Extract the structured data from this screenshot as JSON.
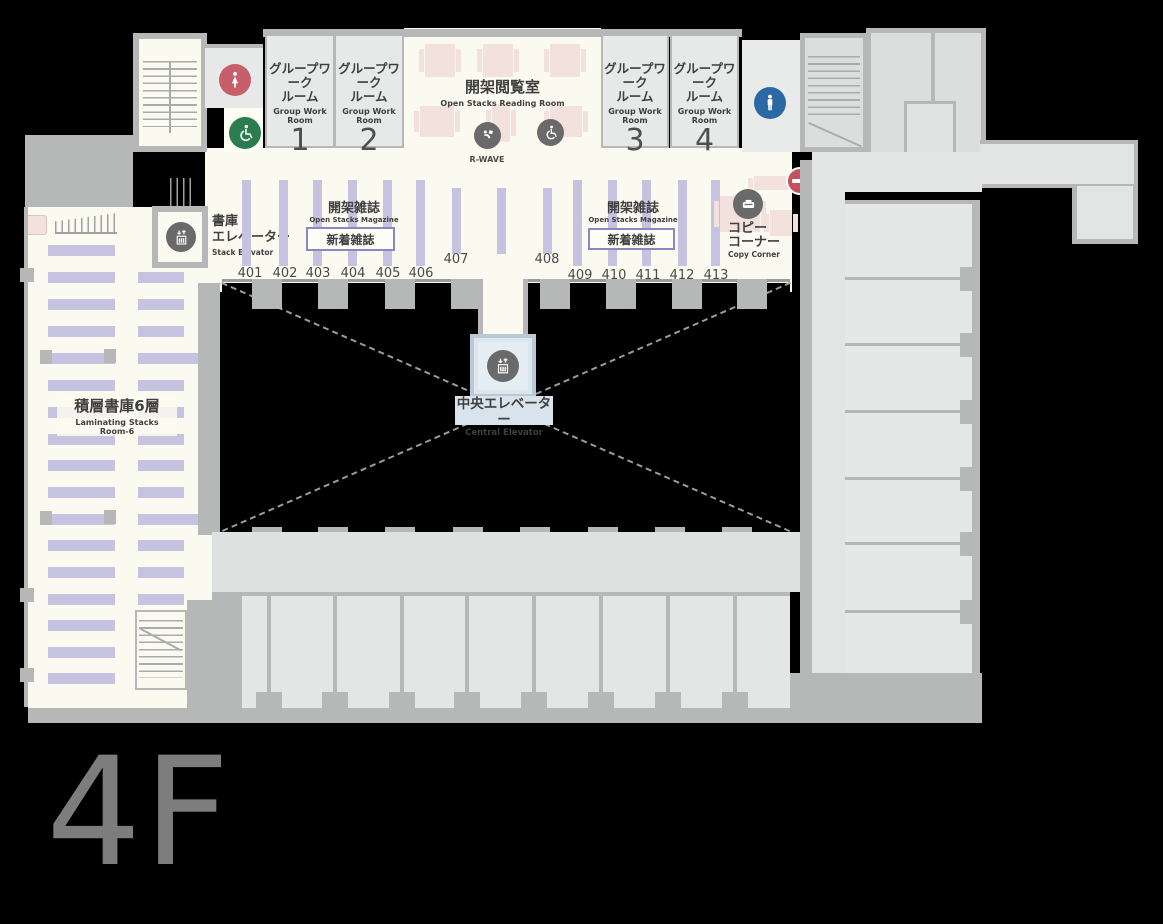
{
  "floor_label": "4F",
  "rooms": {
    "group_work": [
      {
        "jp1": "グループワーク",
        "jp2": "ルーム",
        "en": "Group Work Room",
        "num": "1"
      },
      {
        "jp1": "グループワーク",
        "jp2": "ルーム",
        "en": "Group Work Room",
        "num": "2"
      },
      {
        "jp1": "グループワーク",
        "jp2": "ルーム",
        "en": "Group Work Room",
        "num": "3"
      },
      {
        "jp1": "グループワーク",
        "jp2": "ルーム",
        "en": "Group Work Room",
        "num": "4"
      }
    ],
    "reading_room": {
      "jp": "開架閲覧室",
      "en": "Open Stacks Reading Room"
    },
    "rwave_label": "R-WAVE",
    "magazines": {
      "jp": "開架雑誌",
      "en": "Open Stacks Magazine",
      "new_box": "新着雑誌"
    },
    "stack_elevator": {
      "jp_line1": "書庫",
      "jp_line2": "エレベーター",
      "en": "Stack Elevator"
    },
    "central_elevator": {
      "jp": "中央エレベーター",
      "en": "Central Elevator"
    },
    "laminating_stacks": {
      "jp": "積層書庫6層",
      "en_line1": "Laminating Stacks",
      "en_line2": "Room-6"
    },
    "copy_corner": {
      "jp_line1": "コピー",
      "jp_line2": "コーナー",
      "en": "Copy Corner"
    }
  },
  "shelves": {
    "numbers": [
      "401",
      "402",
      "403",
      "404",
      "405",
      "406",
      "407",
      "408",
      "409",
      "410",
      "411",
      "412",
      "413"
    ]
  },
  "icons": {
    "female_toilet": {
      "name": "female-toilet-icon",
      "color": "#c75f6b"
    },
    "accessible_toilet": {
      "name": "accessible-toilet-icon",
      "color": "#2c7c50"
    },
    "male_toilet": {
      "name": "male-toilet-icon",
      "color": "#2b69a5"
    },
    "reading_accessible": {
      "name": "wheelchair-icon",
      "color": "#6a6a6a"
    },
    "rwave": {
      "name": "rwave-terminal-icon",
      "color": "#6a6a6a"
    },
    "stack_elevator": {
      "name": "elevator-icon",
      "color": "#6a6a6a"
    },
    "central_elevator": {
      "name": "elevator-icon",
      "color": "#6a6a6a"
    },
    "copier": {
      "name": "copier-icon",
      "color": "#6a6a6a"
    },
    "no_entry": {
      "name": "no-entry-icon",
      "color": "#c5515c"
    }
  },
  "colors": {
    "floor_cream": "#fbfaf1",
    "room_gray": "#e7e9e8",
    "wall_gray": "#b5b8b7",
    "shelf_lavender": "#c5c3e0",
    "table_pink": "#f2e1dc",
    "elevator_blue": "#dbe6ef",
    "void_black": "#000000",
    "floor_label_gray": "#7d7d7d"
  }
}
